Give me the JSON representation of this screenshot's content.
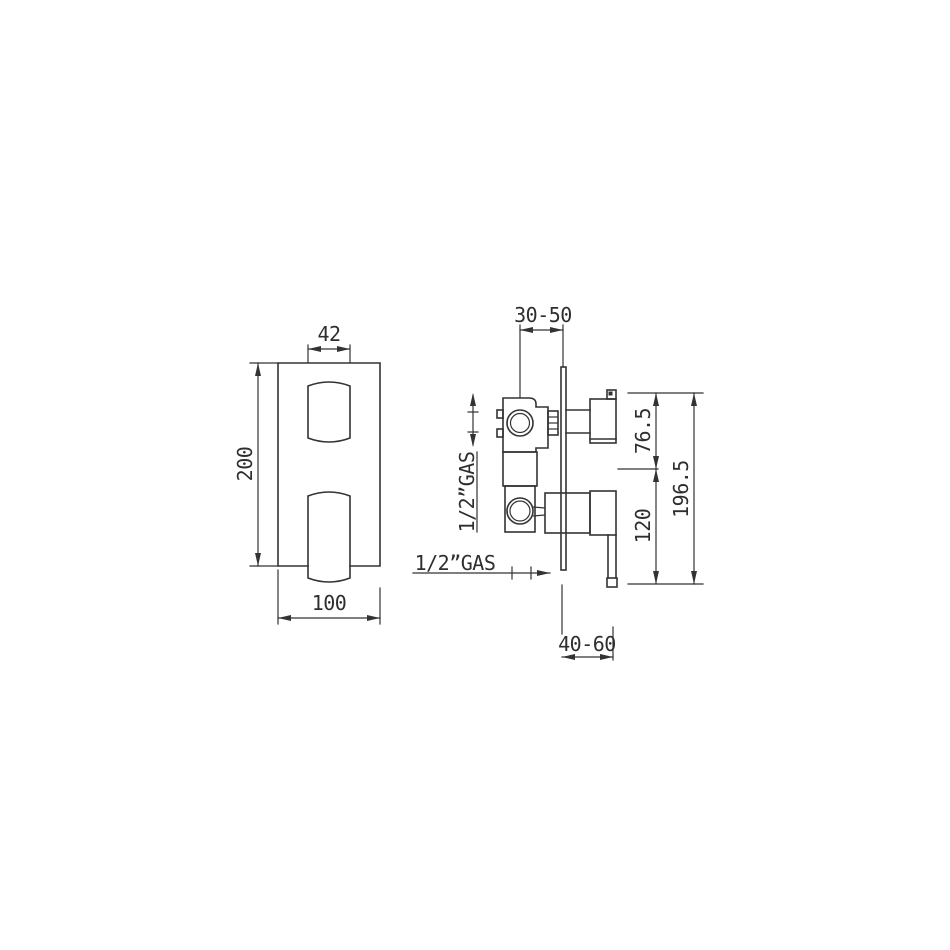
{
  "drawing": {
    "title": "concealed-shower-mixer-technical-drawing",
    "front_view": {
      "label_handle_width": "42",
      "label_plate_height": "200",
      "label_plate_width": "100"
    },
    "side_view": {
      "label_recess_depth": "30-50",
      "label_inlet_thread": "1/2”GAS",
      "label_outlet_thread": "1/2”GAS",
      "label_upper_span": "76.5",
      "label_lower_span": "120",
      "label_total_span": "196.5",
      "label_projection": "40-60"
    },
    "colors": {
      "line": "#333333",
      "background": "#ffffff"
    }
  }
}
